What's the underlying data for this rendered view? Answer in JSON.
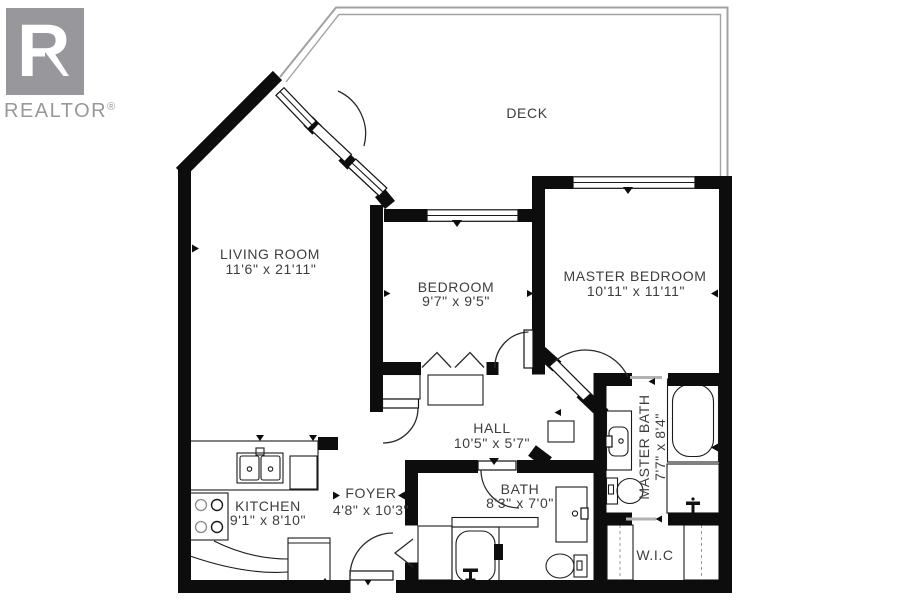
{
  "logo": {
    "letter": "R",
    "brand": "REALTOR",
    "registered": "®"
  },
  "rooms": [
    {
      "id": "deck",
      "name": "DECK",
      "dims": ""
    },
    {
      "id": "living",
      "name": "LIVING ROOM",
      "dims": "11'6\" x 21'11\""
    },
    {
      "id": "bedroom",
      "name": "BEDROOM",
      "dims": "9'7\" x 9'5\""
    },
    {
      "id": "master",
      "name": "MASTER BEDROOM",
      "dims": "10'11\" x 11'11\""
    },
    {
      "id": "hall",
      "name": "HALL",
      "dims": "10'5\" x 5'7\""
    },
    {
      "id": "kitchen",
      "name": "KITCHEN",
      "dims": "9'1\" x 8'10\""
    },
    {
      "id": "foyer",
      "name": "FOYER",
      "dims": "4'8\" x 10'3\""
    },
    {
      "id": "bath",
      "name": "BATH",
      "dims": "8'3\" x 7'0\""
    },
    {
      "id": "masterbath",
      "name": "MASTER BATH",
      "dims": "7'7\" x 8'4\""
    },
    {
      "id": "wic",
      "name": "W.I.C",
      "dims": ""
    }
  ],
  "colors": {
    "wall": "#0d0d0d",
    "text": "#3e3e40",
    "logo": "#98989c",
    "railing": "#a2a2a2"
  }
}
